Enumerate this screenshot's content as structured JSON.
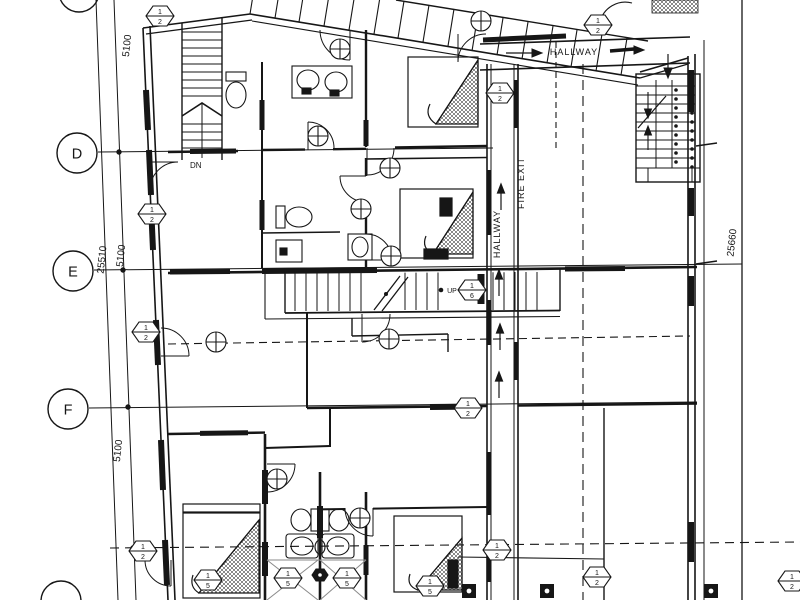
{
  "drawing": {
    "kind": "architectural floor plan",
    "ink_color": "#161616",
    "background_color": "#ffffff"
  },
  "grid_labels": {
    "d": "D",
    "e": "E",
    "f": "F"
  },
  "dimensions": {
    "left_top": "5100",
    "left_overall": "25510",
    "left_mid": "5100",
    "left_bottom": "5100",
    "right_overall": "25660"
  },
  "labels": {
    "hallway_top": "HALLWAY",
    "hallway_vertical": "HALLWAY",
    "fire_exit": "FIRE EXIT",
    "down": "DN",
    "up": "UP"
  },
  "tags": {
    "t1": {
      "top": "1",
      "bottom": "2"
    },
    "t2": {
      "top": "1",
      "bottom": "2"
    },
    "t3": {
      "top": "1",
      "bottom": "2"
    },
    "t4": {
      "top": "1",
      "bottom": "2"
    },
    "t5": {
      "top": "1",
      "bottom": "2"
    },
    "t6": {
      "top": "1",
      "bottom": "6"
    },
    "t7": {
      "top": "1",
      "bottom": "2"
    },
    "t8": {
      "top": "1",
      "bottom": "2"
    },
    "t9": {
      "top": "1",
      "bottom": "5"
    },
    "t10": {
      "top": "1",
      "bottom": "5"
    },
    "t11": {
      "top": "1",
      "bottom": "5"
    },
    "t12": {
      "top": "1",
      "bottom": "5"
    },
    "t13": {
      "top": "1",
      "bottom": "2"
    },
    "t14": {
      "top": "1",
      "bottom": "2"
    },
    "t15": {
      "top": "1",
      "bottom": "2"
    }
  }
}
